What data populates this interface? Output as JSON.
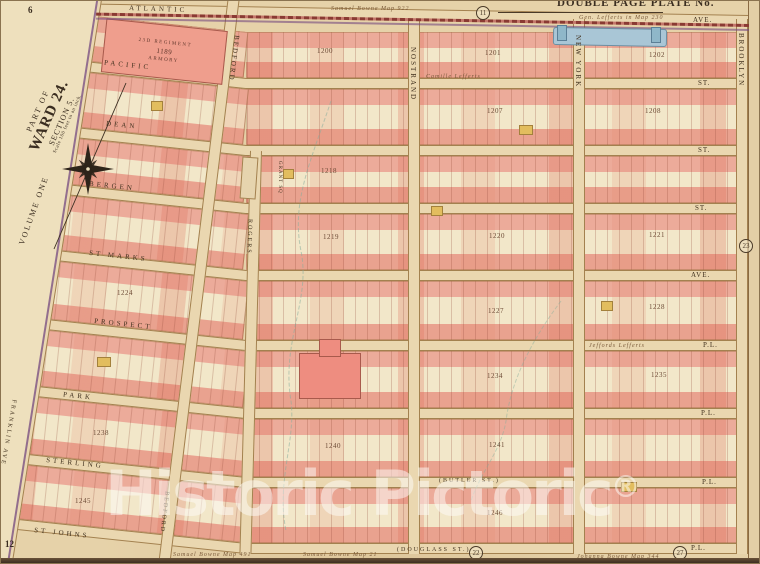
{
  "header": {
    "plate_title": "DOUBLE PAGE PLATE No.",
    "note_left": "Samuel Bowne Map 922",
    "note_right": "Gen. Lefferts in Map 230"
  },
  "margin": {
    "part_of": "PART OF",
    "ward": "WARD 24.",
    "section": "SECTION 5.",
    "scale": "Scale 100 feet to an inch.",
    "volume": "VOLUME ONE"
  },
  "streets": {
    "horizontal": [
      {
        "name": "ATLANTIC",
        "east": "AVE."
      },
      {
        "name": "PACIFIC",
        "east": "ST."
      },
      {
        "name": "DEAN",
        "east": "ST."
      },
      {
        "name": "BERGEN",
        "east": "ST."
      },
      {
        "name": "ST MARKS",
        "east": "AVE."
      },
      {
        "name": "PROSPECT",
        "east": "P.L."
      },
      {
        "name": "PARK",
        "east": "P.L."
      },
      {
        "name": "STERLING",
        "east": "P.L.",
        "alt": "(BUTLER ST.)"
      },
      {
        "name": "ST JOHNS",
        "east": "P.L.",
        "alt": "(DOUGLASS ST.)"
      }
    ],
    "vertical": [
      "FRANKLIN AVE",
      "BEDFORD",
      "ROGERS",
      "NOSTRAND",
      "NEW YORK",
      "BROOKLYN"
    ],
    "square": "GRANT SQ"
  },
  "landmarks": {
    "armory_l1": "23D REGIMENT",
    "armory_l2": "1189",
    "armory_l3": "ARMORY"
  },
  "blocks": [
    "1200",
    "1201",
    "1202",
    "1207",
    "1208",
    "1218",
    "1219",
    "1220",
    "1221",
    "1224",
    "1227",
    "1228",
    "1234",
    "1235",
    "1238",
    "1240",
    "1241",
    "1245",
    "1246"
  ],
  "markers": [
    "11",
    "23",
    "22",
    "27"
  ],
  "corner_refs": [
    "6",
    "12"
  ],
  "map_notes": [
    "Camille Lefferts",
    "Jeffords Lefferts"
  ],
  "footer_notes": [
    "Samuel Bowne Map 491",
    "Samuel Bowne Map 21",
    "Johanna Bowne Map 344"
  ],
  "watermark": {
    "text": "Historic Pictoric",
    "symbol": "®"
  },
  "colors": {
    "paper": "#e6d2a9",
    "block_cream": "#f2e7c9",
    "building_pink": "#ecab9a",
    "building_red": "#db6a56",
    "building_yellow": "#e2bd5e",
    "street_fill": "#ead7b0",
    "street_line": "#a3814f",
    "railroad_maroon": "#8a3a33",
    "ward_boundary_purple": "#744a80",
    "water_blue": "#a9c6d6",
    "watermark_white": "rgba(253,252,248,0.52)"
  }
}
